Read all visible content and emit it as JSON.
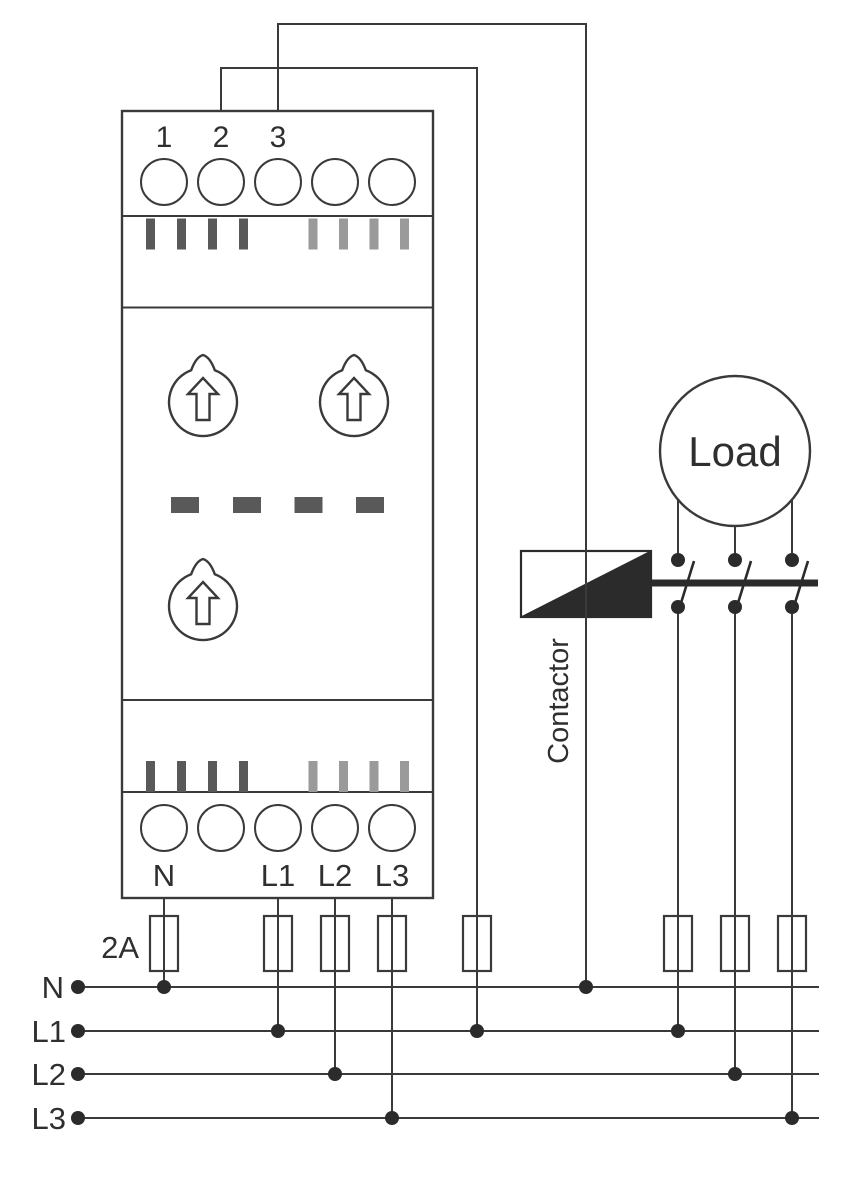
{
  "device": {
    "top_terminal_labels": [
      "1",
      "2",
      "3"
    ],
    "bottom_terminal_labels": [
      "N",
      "L1",
      "L2",
      "L3"
    ]
  },
  "contactor": {
    "label": "Contactor"
  },
  "load": {
    "label": "Load"
  },
  "fuse": {
    "rating_label": "2A"
  },
  "bus": {
    "labels": [
      "N",
      "L1",
      "L2",
      "L3"
    ]
  },
  "colors": {
    "line": "#3a3a3a",
    "solid_fill": "#2b2b2b",
    "dark_slot": "#595959",
    "light_slot": "#9a9a9a",
    "text": "#2f2f2f",
    "background": "#ffffff"
  }
}
